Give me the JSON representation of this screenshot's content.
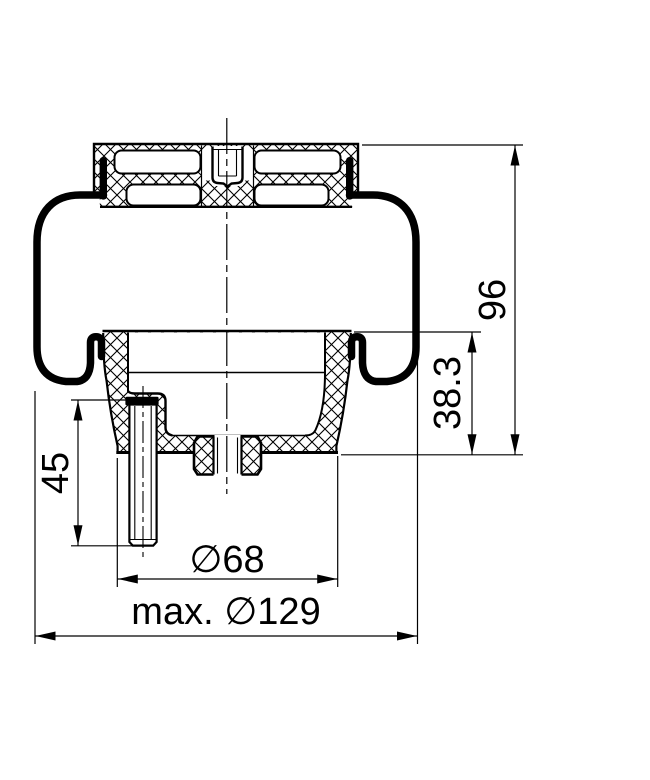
{
  "drawing": {
    "kind": "air-spring-cross-section",
    "colors": {
      "line": "#000000",
      "background": "#ffffff"
    },
    "dimensions": {
      "overall_height": "96",
      "lower_height": "38.3",
      "stud_length": "45",
      "piston_diameter": "∅68",
      "max_diameter": "max. ∅129"
    }
  }
}
